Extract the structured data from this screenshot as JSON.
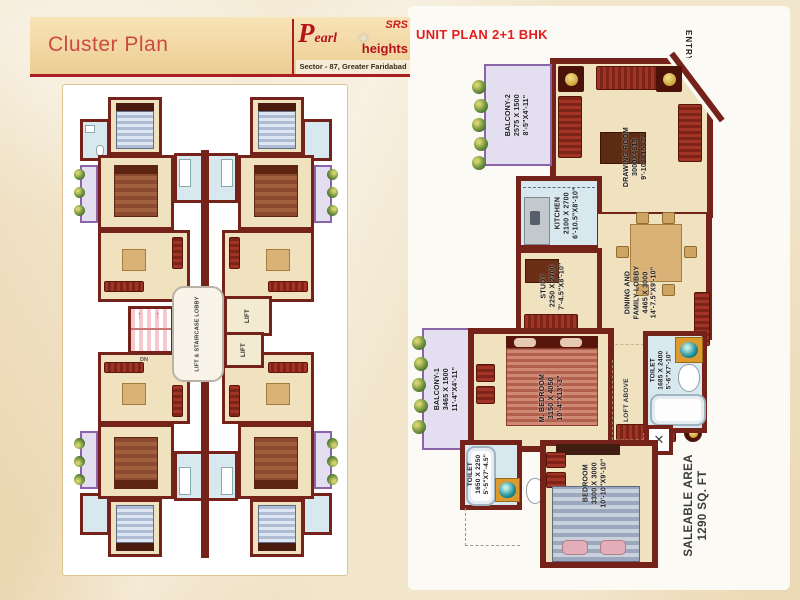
{
  "header": {
    "title": "Cluster Plan",
    "brand": {
      "srs": "SRS",
      "flower": "❀",
      "pearl_initial": "P",
      "pearl_rest": "earl",
      "heights": "heights",
      "subtitle": "Sector - 87, Greater Faridabad"
    }
  },
  "unit_plan": {
    "title": "UNIT PLAN 2+1 BHK",
    "entry_label": "ENTRY",
    "loft_label": "LOFT ABOVE",
    "saleable_line1": "SALEABLE AREA",
    "saleable_line2": "1290 SQ. FT",
    "rooms": {
      "balcony2": {
        "name": "BALCONY-2",
        "mm": "2575 X 1500",
        "ft": "8'-5\"X4'-11\""
      },
      "drawing": {
        "name": "DRAWING ROOM",
        "mm": "3000X4615",
        "ft": "9'-10\"X15'-2\""
      },
      "kitchen": {
        "name": "KITCHEN",
        "mm": "2100 X 2700",
        "ft": "6'-10.5\"X8'-10\""
      },
      "dining": {
        "name1": "DINING AND",
        "name2": "FAMILY LOBBY",
        "mm": "4465 X 3000",
        "ft": "14'-7.5\"X9'-10\""
      },
      "study": {
        "name": "STUDY",
        "mm": "2250 X 2700",
        "ft": "7'-4.5\"X8'-10\""
      },
      "balcony1": {
        "name": "BALCONY-1",
        "mm": "3465 X 1500",
        "ft": "11'-4\"X4'-11\""
      },
      "mbedroom": {
        "name": "M. BEDROOM",
        "mm": "3150 X 4050",
        "ft": "10'-4\"X13'-3\""
      },
      "toilet1": {
        "name": "TOILET",
        "mm": "1685 X 2400",
        "ft": "5'-6\"X7'-10\""
      },
      "toilet2": {
        "name": "TOILET",
        "mm": "1650 X 2250",
        "ft": "5'-5\"X7'-4.5\""
      },
      "bedroom": {
        "name": "BEDROOM",
        "mm": "3300 X 3000",
        "ft": "10'-10\"X9'-10\""
      }
    }
  },
  "cluster_plan": {
    "lift_label": "LIFT",
    "lobby_label": "LIFT & STAIRCASE LOBBY",
    "stairs_label": "DN"
  },
  "colors": {
    "accent_red": "#e41e20",
    "brand_red": "#b5121b",
    "wall_maroon": "#75221a",
    "room_cream": "#f0e1bf",
    "wet_blue": "#d7e8ef",
    "balcony_lavender": "#e3def0",
    "balcony_purple": "#8a63a8",
    "header_tan": "#eccd92"
  }
}
